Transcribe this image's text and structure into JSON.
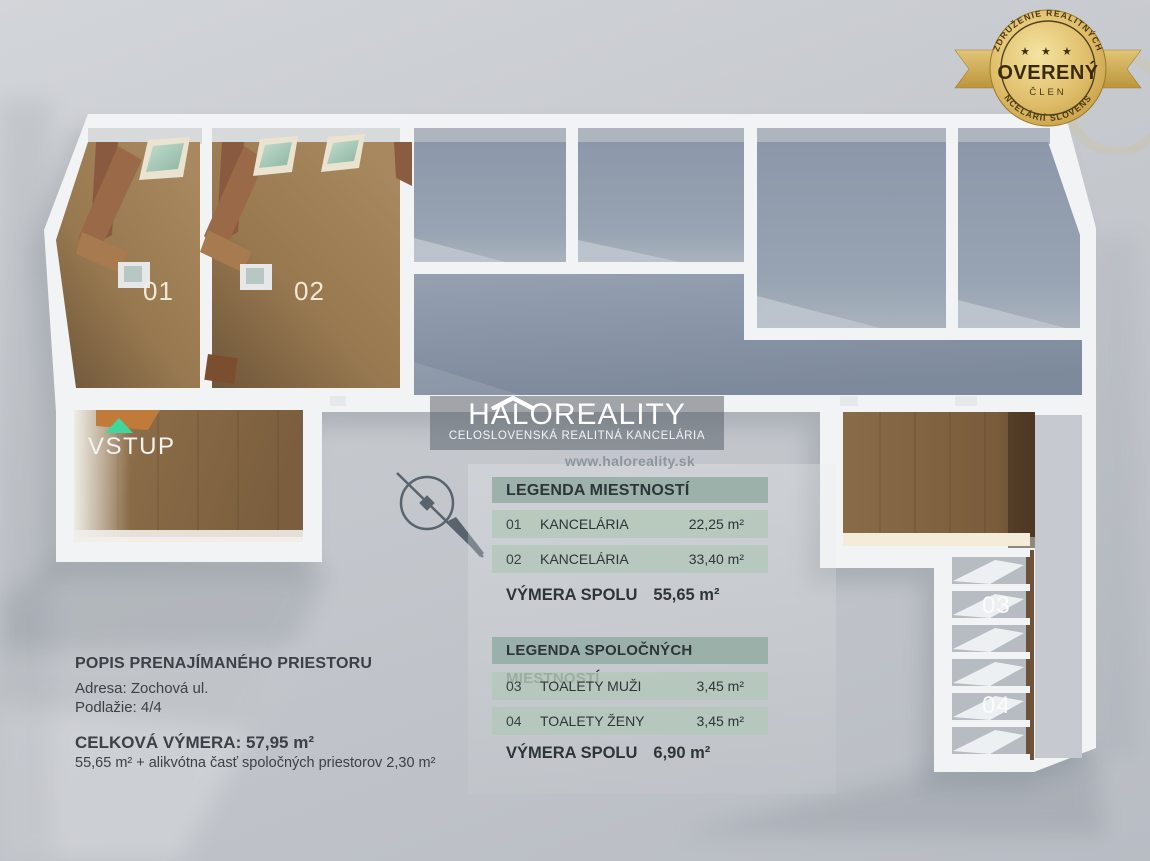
{
  "badge": {
    "arc_top": "ZDRUŽENIE REALITNÝCH",
    "stars": "★ ★ ★",
    "title": "OVERENÝ",
    "member": "ČLEN",
    "arc_bottom": "KANCELÁRIÍ SLOVENSKA"
  },
  "logo": {
    "name": "HALOREALITY",
    "subtitle": "CELOSLOVENSKÁ REALITNÁ KANCELÁRIA",
    "website": "www.haloreality.sk"
  },
  "plan": {
    "entry_label": "VSTUP",
    "room_labels": [
      "01",
      "02",
      "03",
      "04"
    ]
  },
  "legend_rooms": {
    "title": "LEGENDA MIESTNOSTÍ",
    "rows": [
      {
        "id": "01",
        "label": "KANCELÁRIA",
        "area": "22,25 m²"
      },
      {
        "id": "02",
        "label": "KANCELÁRIA",
        "area": "33,40 m²"
      }
    ],
    "total_label": "VÝMERA SPOLU",
    "total_area": "55,65 m²"
  },
  "legend_common": {
    "title": "LEGENDA SPOLOČNÝCH MIESTNOSTÍ",
    "rows": [
      {
        "id": "03",
        "label": "TOALETY MUŽI",
        "area": "3,45 m²"
      },
      {
        "id": "04",
        "label": "TOALETY ŽENY",
        "area": "3,45 m²"
      }
    ],
    "total_label": "VÝMERA SPOLU",
    "total_area": "6,90 m²"
  },
  "description": {
    "title": "POPIS PRENAJÍMANÉHO PRIESTORU",
    "address": "Adresa: Zochová ul.",
    "floor": "Podlažie: 4/4",
    "total": "CELKOVÁ VÝMERA: 57,95 m²",
    "total_note": "55,65 m² + alikvótna časť spoločných priestorov 2,30 m²"
  },
  "colors": {
    "badge_gold": "#d9b763",
    "entry_arrow_green": "#3fd79e",
    "office_floor_wood": "#9c7b52",
    "common_floor_gray": "#93a0b0",
    "legend_header_green": "#94aca4",
    "legend_row_green": "#b3c7ba"
  }
}
